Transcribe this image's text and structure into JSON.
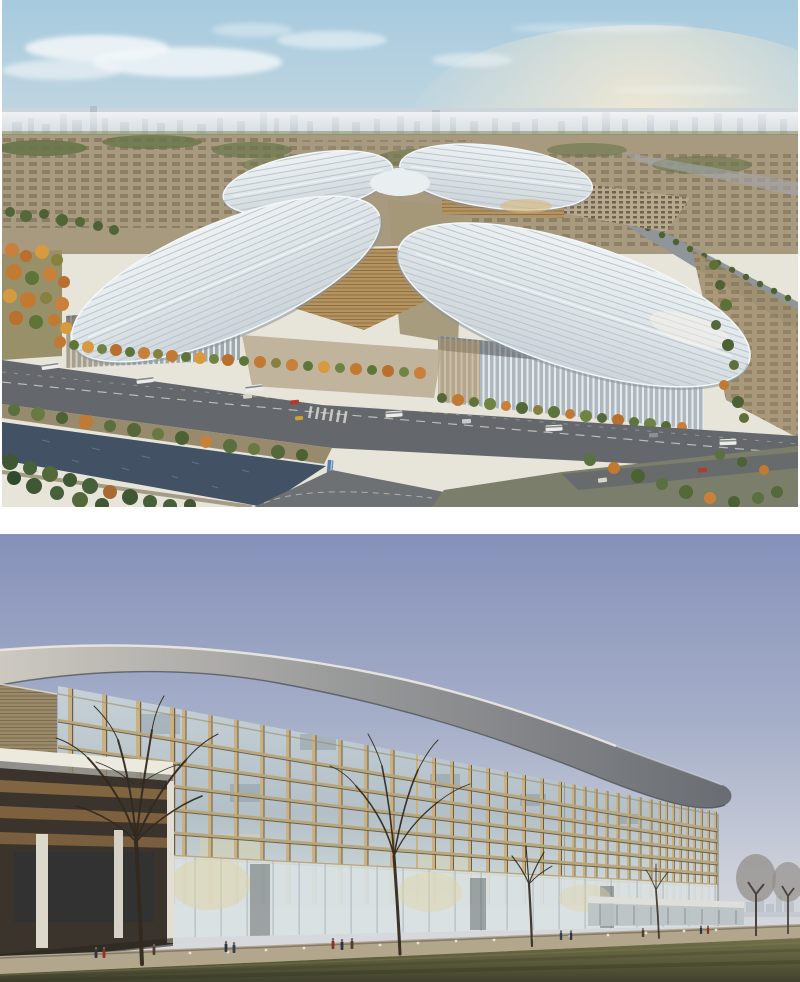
{
  "page": {
    "background": "#ffffff"
  },
  "figures": {
    "aerial": {
      "name": "aerial-view-rendering",
      "alt": "Aerial rendering of a four-leaf-clover shaped exhibition complex with white ribbed oval roofs around a central hub, golden entrance pavilions, autumn tree rows, a wide boulevard with buses, a tree-lined canal, parking areas, a highway and a hazy city skyline"
    },
    "facade": {
      "name": "facade-view-rendering",
      "alt": "Street-level rendering of a long curved glass facade with vertical golden fins beneath a sweeping grey roof band that dips to the right, with a lawn, bare trees, bollard lights and pedestrians in front under a periwinkle sky"
    }
  },
  "theme": {
    "t-o1": "#c27a32",
    "t-o2": "#b96f2e",
    "t-o3": "#d79a3e",
    "t-o4": "#c8803a",
    "t-o5": "#c07a33",
    "t-o6": "#a86a30",
    "t-y1": "#87813f",
    "t-g1": "#5d7539",
    "t-g2": "#6f8444",
    "t-g3": "#55683a",
    "t-g4": "#4c6234",
    "t-g5": "#5a6f3e",
    "t-g6": "#687a42",
    "t-g7": "#3f5733",
    "t-g8": "#46603a",
    "t-g9": "#4f6538",
    "t-g10": "#5d7038",
    "t-g11": "#2f4a2c",
    "t-g12": "#5a7040",
    "f1-sky-top": "#a6cade",
    "f1-sky-mid": "#c0d6e1",
    "f1-sky-low": "#d9e0df",
    "f1-sky-horizon": "#e7e5da",
    "f1-glow": "#f6ead2",
    "f1-cloud": "#f3f7f9",
    "f1-skyband": "#ccd4d9",
    "f1-skyline": "#b0bcc4",
    "f1-mid": "#a89a7f",
    "f1-midblock": "#6f614a",
    "f1-green": "#68764a",
    "f1-treeline": "#7c8a58",
    "f1-mid2": "#979068",
    "f1-mid3": "#a39878",
    "f1-hwy": "#90959a",
    "f1-hwy2": "#a3a7ab",
    "f1-park": "#b7a88c",
    "f1-parkdot": "#5c5044",
    "f1-blocks": "#a2906f",
    "f1-roof-1": "#eef2f4",
    "f1-roof-2": "#ccd5da",
    "f1-rib": "#b4bfc8",
    "f1-rim": "#f4f7f8",
    "f1-eave": "#89939b",
    "f1-roof-hi": "#f0f4f6",
    "f1-hub": "#e9eef1",
    "f1-gold": "#b5935f",
    "f1-gold-dk": "#8a6c42",
    "f1-louv": "#7c5f38",
    "f1-goldglow": "#d8b878",
    "f1-wallglass": "#9fa8ad",
    "f1-wallglass2": "#aeb9bf",
    "f1-finw": "#eef1f2",
    "f1-shadow": "#474d52",
    "f1-plaza": "#b9ab90",
    "f1-road": "#64676b",
    "f1-lane": "#d9d8d2",
    "f1-bus": "#ecebe5",
    "f1-buswin": "#5a646e",
    "f1-busblue": "#5a7fa8",
    "f1-car-red": "#b23a2e",
    "f1-car-gray": "#c8ccd0",
    "f1-car-dk": "#8a9096",
    "f1-car-lt": "#d8d4cc",
    "f1-car-yellow": "#c8a23a",
    "f1-bank": "#8f7f60",
    "f1-water": "#425264",
    "f1-sparkle": "#7d90a6",
    "f1-road2": "#6e7174",
    "f1-brbase": "#7b7e6a",
    "f1-pathbr": "#7a6a50",
    "f1-glint": "#f8f4ea",
    "f2-sky-top": "#8591b9",
    "f2-sky-mid": "#a6afc9",
    "f2-sky-low": "#cbcfd9",
    "f2-sky-horizon": "#d8dade",
    "f2-city": "#bac1c9",
    "f2-citybase": "#c3c8cf",
    "f2-glass-1": "#c6d1d7",
    "f2-glass-2": "#b3c0c7",
    "f2-glass-3": "#cdd7d8",
    "f2-glass-4": "#dfe4e2",
    "f2-pane-dk": "#5f6e79",
    "f2-pane-warm": "#e0d4a4",
    "f2-floor": "#b8a67c",
    "f2-floor-dk": "#6b5f48",
    "f2-parapet": "#9a8c6c",
    "f2-fin": "#c9b183",
    "f2-fin-dk": "#6e5c40",
    "f2-gf": "#d9e1e2",
    "f2-mullion": "#8d9aa2",
    "f2-slot": "#3e4440",
    "f2-band-1": "#cdc9c1",
    "f2-band-2": "#9a9b9b",
    "f2-band-3": "#686c72",
    "f2-band-hi": "#edeae2",
    "f2-band-dk": "#4b4f55",
    "f2-wing-roof": "#9a8a68",
    "f2-wing-louv": "#6e5f46",
    "f2-wing-roof-hi": "#d8d2c4",
    "f2-canopy": "#eceade",
    "f2-canopy-sh": "#8a857a",
    "f2-wing": "#3b342c",
    "f2-wing-gold": "#8a6a42",
    "f2-wing-glass": "#2c3138",
    "f2-col": "#ddd8cc",
    "f2-col2": "#d6d1c6",
    "f2-col3": "#e2ded4",
    "f2-base-sh": "#2a2620",
    "f2-slab": "#dedfdb",
    "f2-slab-und": "#b9c2c4",
    "f2-slab-line": "#6a6f68",
    "f2-corner": "#8a8578",
    "f2-walk": "#b2a68c",
    "f2-baseline": "#554f46",
    "f2-grass-1": "#7a774e",
    "f2-grass-2": "#5b5b3c",
    "f2-grass-3": "#41422e",
    "f2-grass-dk": "#3c3e2a",
    "f2-grass-dk2": "#34351f",
    "f2-grass-lt": "#8a8656",
    "f2-tree": "#33291f",
    "f2-treegray": "#908c86",
    "f2-trunkgray": "#4a443c",
    "f2-bollard": "#eceae2",
    "f2-p1": "#2c3440",
    "f2-p2": "#513c30",
    "f2-p3": "#8c2f28",
    "f2-p4": "#32404e",
    "f2-head": "#7a6450"
  }
}
